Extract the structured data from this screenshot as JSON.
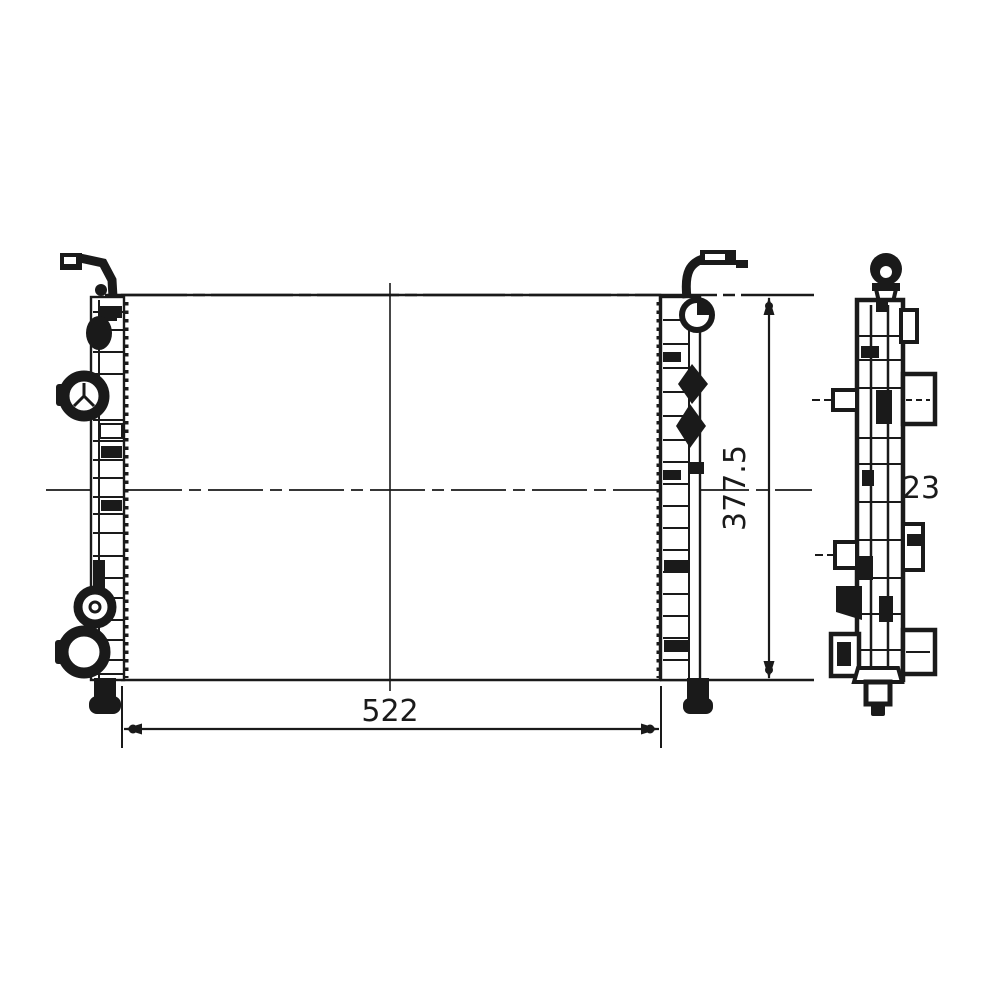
{
  "colors": {
    "background": "#ffffff",
    "line": "#1a1a1a"
  },
  "dimensions": {
    "width": "522",
    "height": "377.5",
    "depth": "23"
  }
}
